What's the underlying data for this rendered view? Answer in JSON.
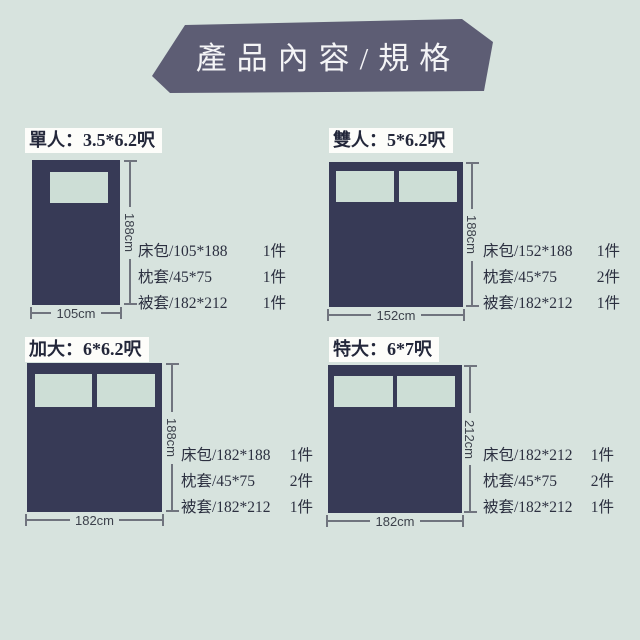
{
  "header": {
    "title": "產品內容/規格"
  },
  "colors": {
    "background": "#d7e3de",
    "banner": "#5d5d74",
    "bed": "#373a56",
    "pillow": "#cdded6",
    "title_text": "#23273a",
    "title_background": "#fdfdfa",
    "spec_text": "#2c3040",
    "dimension_line": "#70747e",
    "dimension_text": "#3c414b"
  },
  "products": [
    {
      "id": "single",
      "title": "單人：3.5*6.2呎",
      "bed_height_label": "188cm",
      "bed_width_label": "105cm",
      "pillow_count": 1,
      "specs": [
        {
          "item": "床包/105*188",
          "qty": "1件"
        },
        {
          "item": "枕套/45*75",
          "qty": "1件"
        },
        {
          "item": "被套/182*212",
          "qty": "1件"
        }
      ]
    },
    {
      "id": "double",
      "title": "雙人：5*6.2呎",
      "bed_height_label": "188cm",
      "bed_width_label": "152cm",
      "pillow_count": 2,
      "specs": [
        {
          "item": "床包/152*188",
          "qty": "1件"
        },
        {
          "item": "枕套/45*75",
          "qty": "2件"
        },
        {
          "item": "被套/182*212",
          "qty": "1件"
        }
      ]
    },
    {
      "id": "queen",
      "title": "加大：6*6.2呎",
      "bed_height_label": "188cm",
      "bed_width_label": "182cm",
      "pillow_count": 2,
      "specs": [
        {
          "item": "床包/182*188",
          "qty": "1件"
        },
        {
          "item": "枕套/45*75",
          "qty": "2件"
        },
        {
          "item": "被套/182*212",
          "qty": "1件"
        }
      ]
    },
    {
      "id": "king",
      "title": "特大：6*7呎",
      "bed_height_label": "212cm",
      "bed_width_label": "182cm",
      "pillow_count": 2,
      "specs": [
        {
          "item": "床包/182*212",
          "qty": "1件"
        },
        {
          "item": "枕套/45*75",
          "qty": "2件"
        },
        {
          "item": "被套/182*212",
          "qty": "1件"
        }
      ]
    }
  ]
}
